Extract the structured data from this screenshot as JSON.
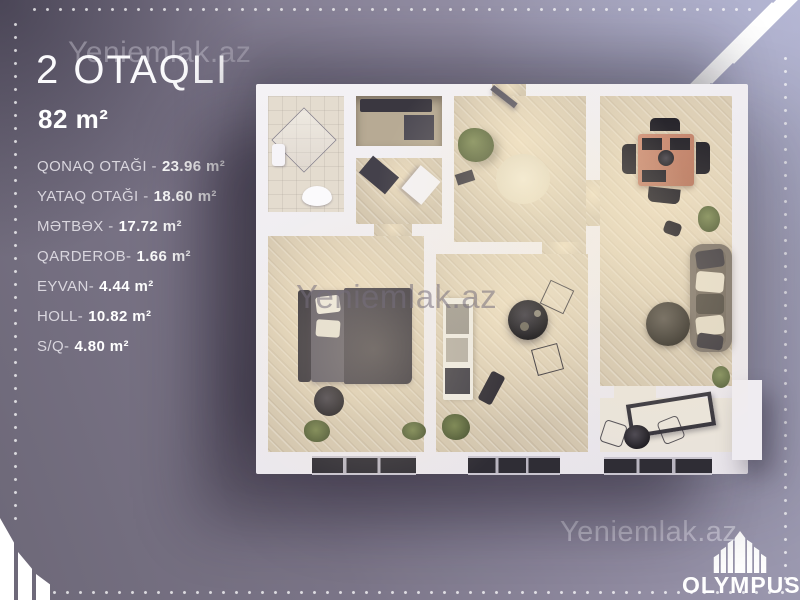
{
  "header": {
    "title": "2 OTAQLI",
    "area": "82 m²"
  },
  "room_list": [
    {
      "label": "QONAQ OTAĞI -",
      "value": "23.96 m²"
    },
    {
      "label": "YATAQ OTAĞI -",
      "value": "18.60 m²"
    },
    {
      "label": "MƏTBƏX -",
      "value": "17.72 m²"
    },
    {
      "label": "QARDEROB-",
      "value": "1.66 m²"
    },
    {
      "label": "EYVAN-",
      "value": "4.44 m²"
    },
    {
      "label": "HOLL-",
      "value": "10.82 m²"
    },
    {
      "label": "S/Q-",
      "value": "4.80 m²"
    }
  ],
  "watermark": {
    "text": "Yeniemlak.az"
  },
  "brand": {
    "name": "OLYMPUS",
    "logo_icon": "olympus-towers-icon"
  },
  "colors": {
    "bg_light": "#a9aac3",
    "bg_dark": "#6d6878",
    "wall": "#efecf1",
    "floor_wood": "#d3c6af",
    "floor_tile": "#e4dccf",
    "furniture_dark": "#26242b",
    "dining_table": "#c7886e",
    "text": "#ffffff"
  }
}
